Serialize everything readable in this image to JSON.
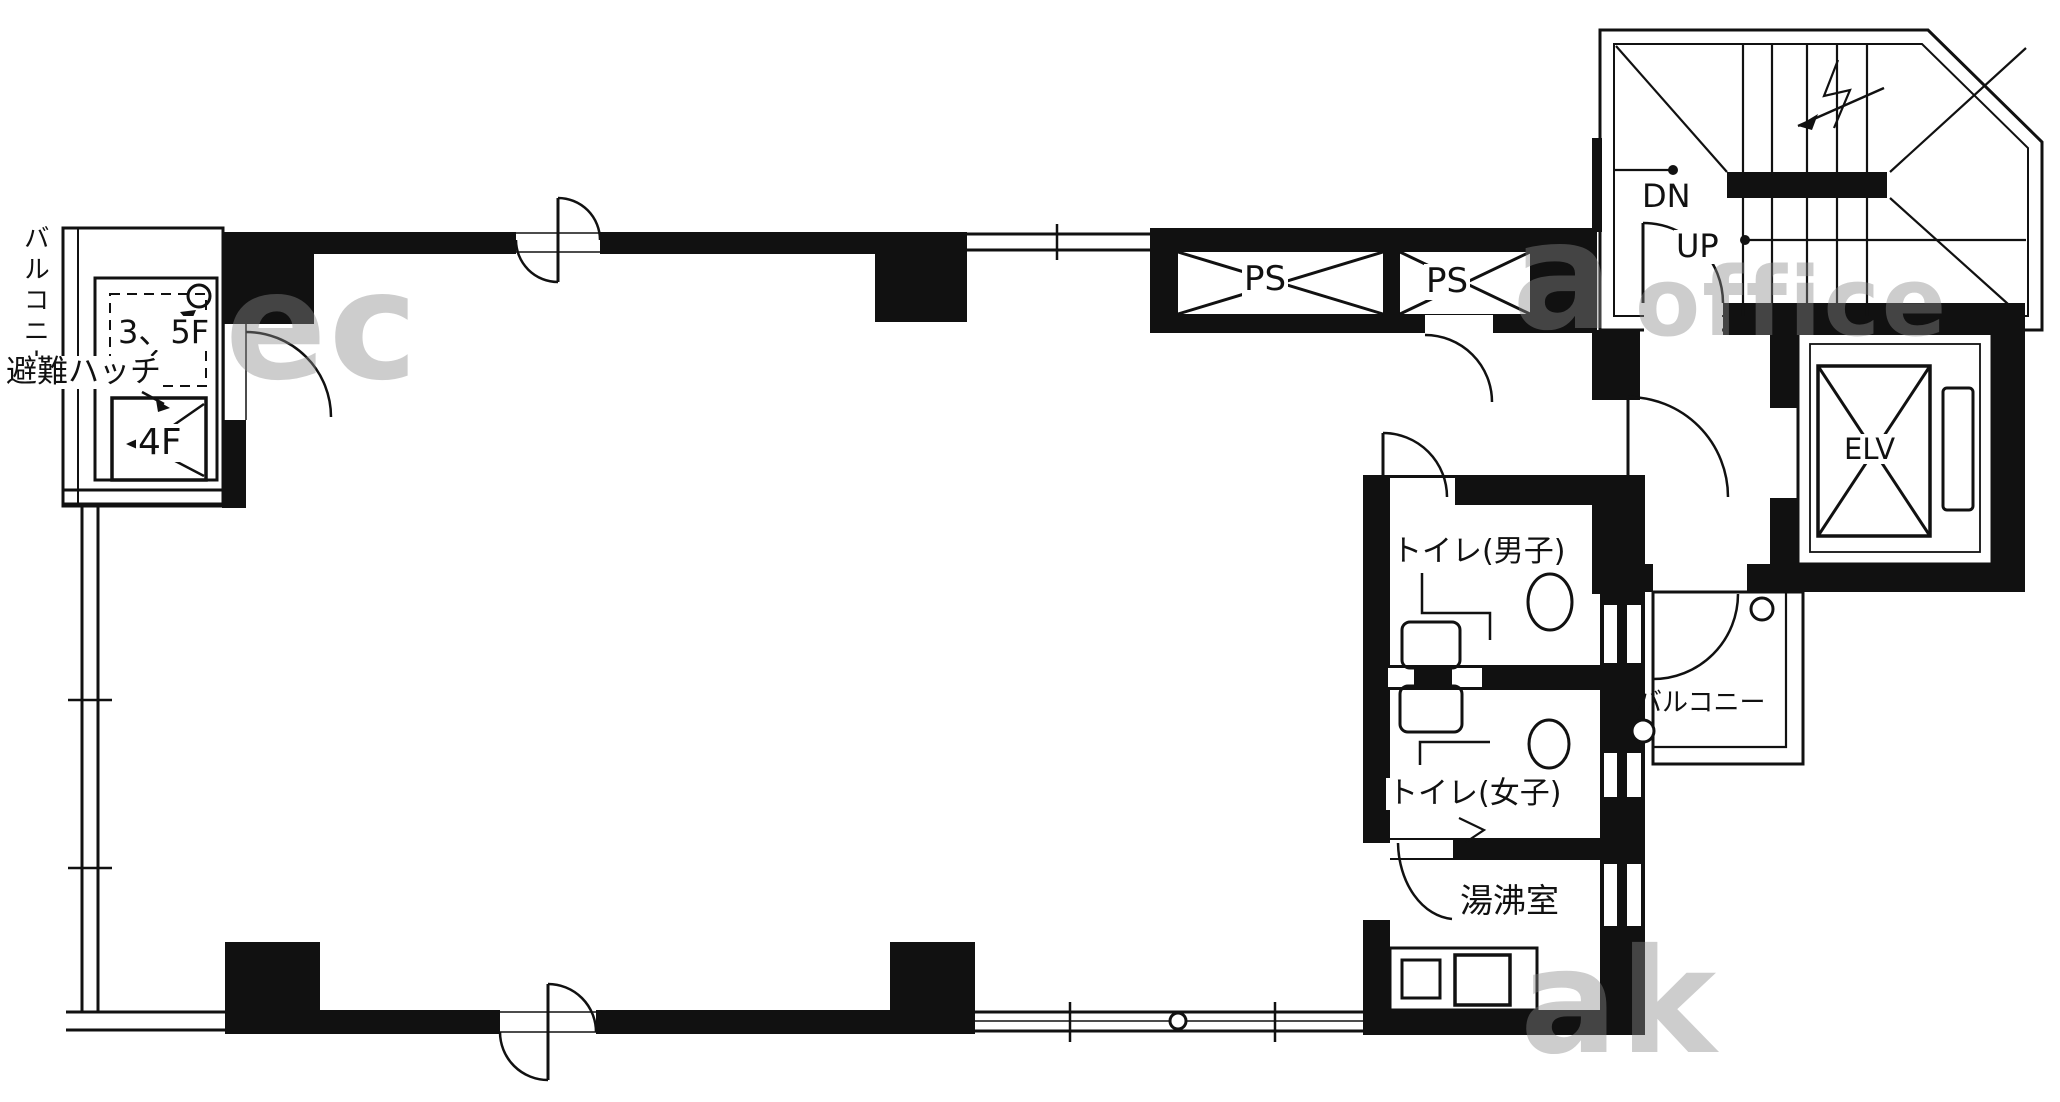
{
  "title": "4F office floor plan",
  "colors": {
    "wall": "#111111",
    "bg": "#ffffff",
    "watermark": "#8a8a8a"
  },
  "labels": {
    "balcony_left": "バルコニー",
    "hatch": "避難ハッチ",
    "hatch_upper": "3、5F",
    "hatch_lower": "4F",
    "ps1": "PS",
    "ps2": "PS",
    "stairs_dn": "DN",
    "stairs_up": "UP",
    "elevator": "ELV",
    "toilet_men": "トイレ(男子)",
    "toilet_women": "トイレ(女子)",
    "balcony_right": "バルコニー",
    "kitchenette": "湯沸室"
  },
  "watermark": {
    "fragments": [
      "ec",
      "a",
      "office",
      "ak"
    ]
  }
}
